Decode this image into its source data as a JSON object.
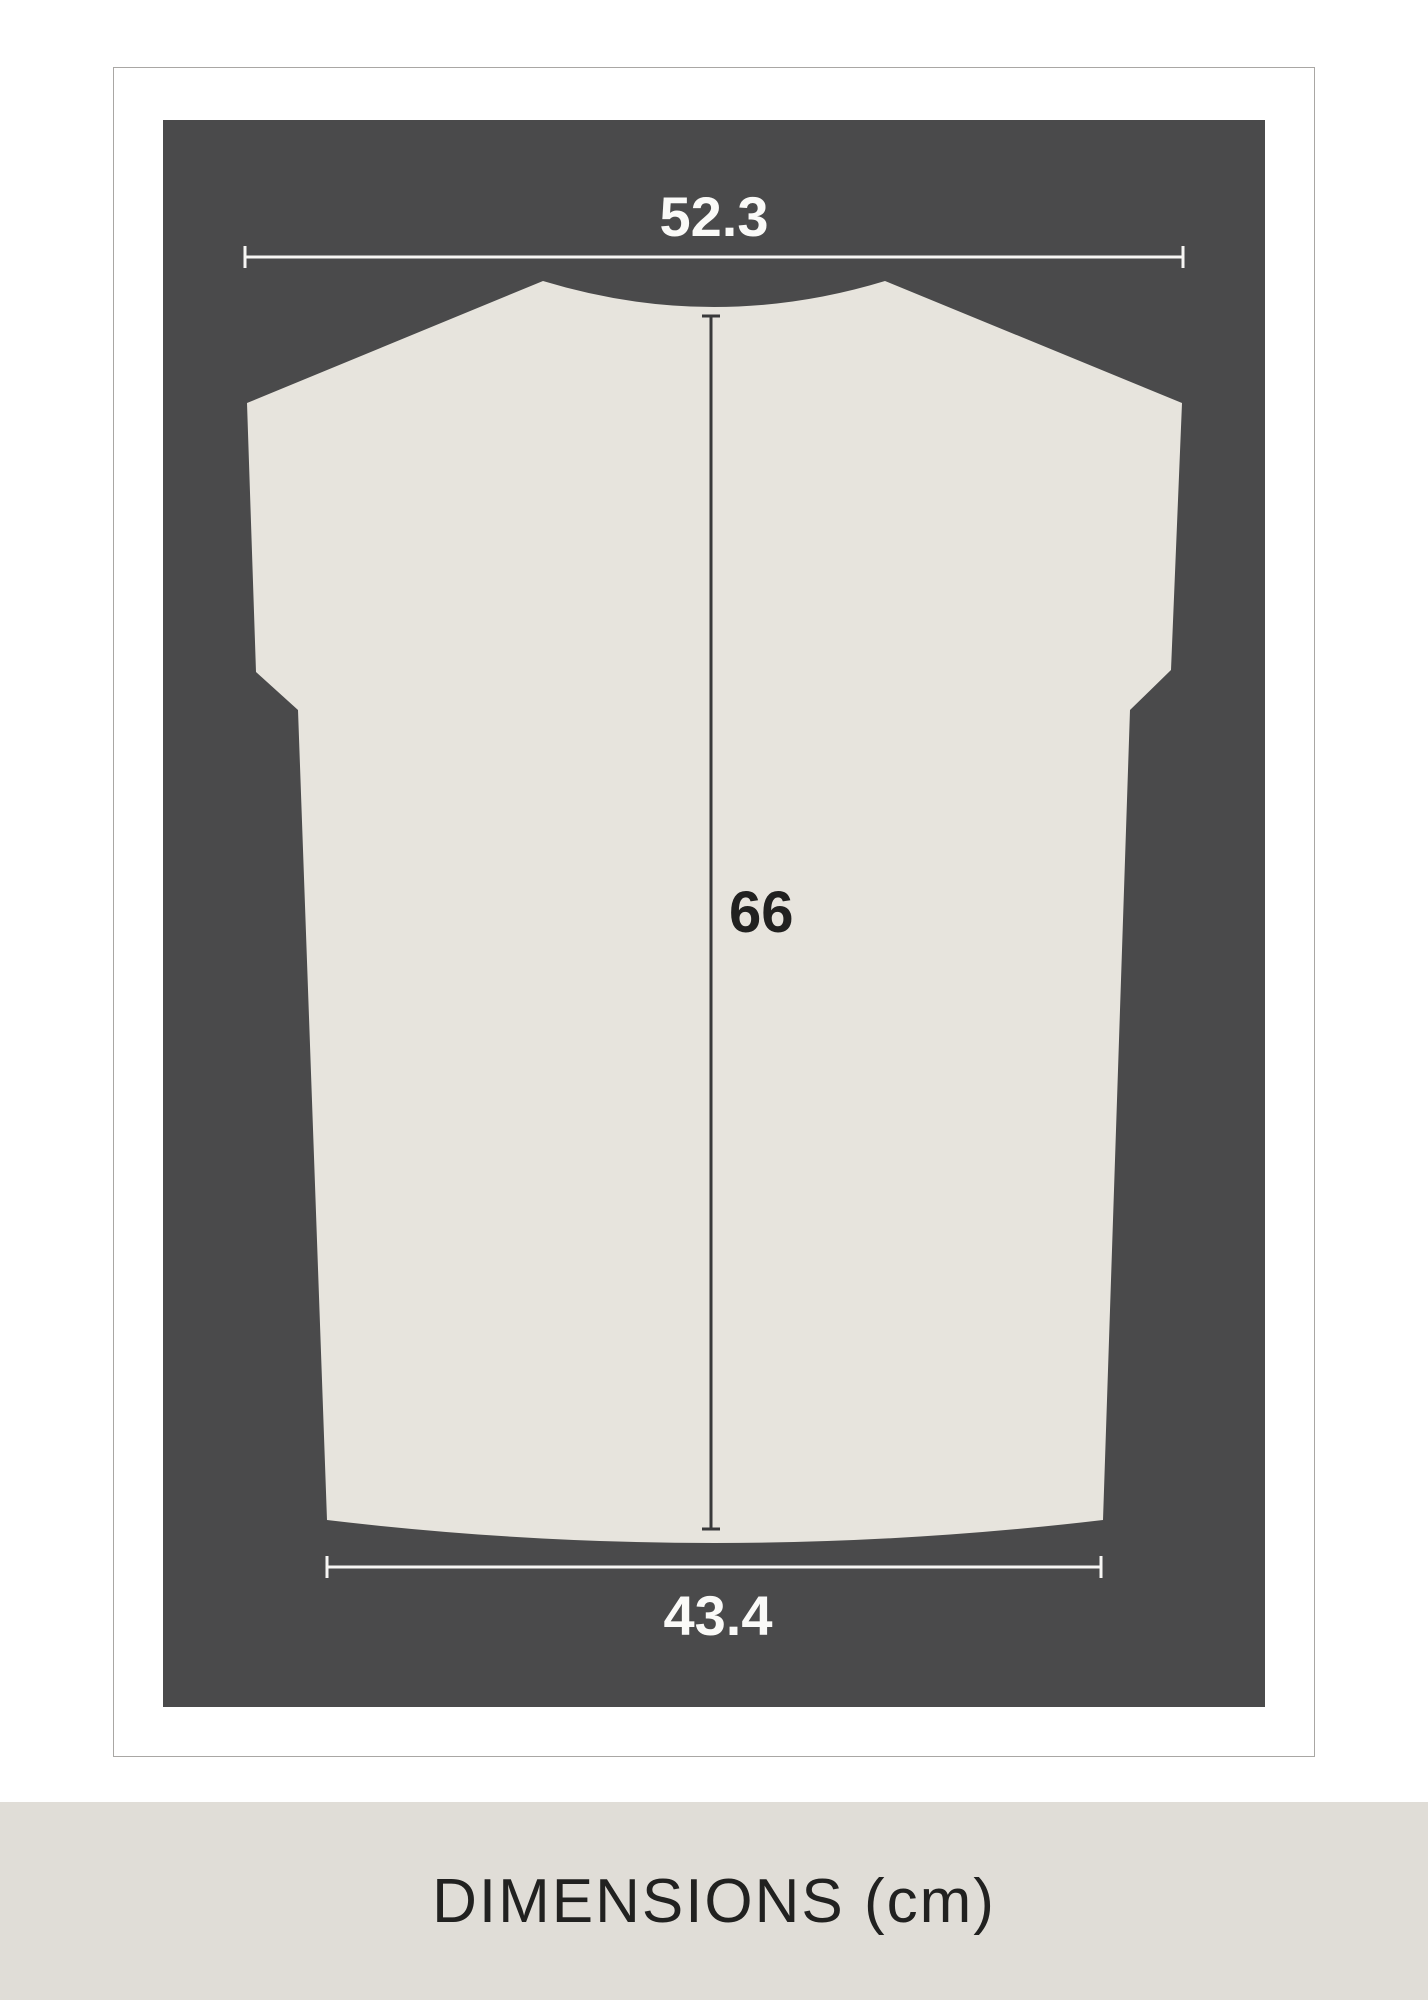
{
  "measurements": {
    "top_width": "52.3",
    "length": "66",
    "bottom_width": "43.4"
  },
  "footer": {
    "label": "DIMENSIONS (cm)"
  },
  "colors": {
    "panel": "#4a4a4b",
    "shirt": "#e7e4dd",
    "footer_bg": "#e0ddd7",
    "light_line": "#f7f6f4",
    "dark_line": "#39393a",
    "text_dark": "#212120",
    "text_light": "#fafaf8",
    "card_border": "#a9a7a4"
  }
}
